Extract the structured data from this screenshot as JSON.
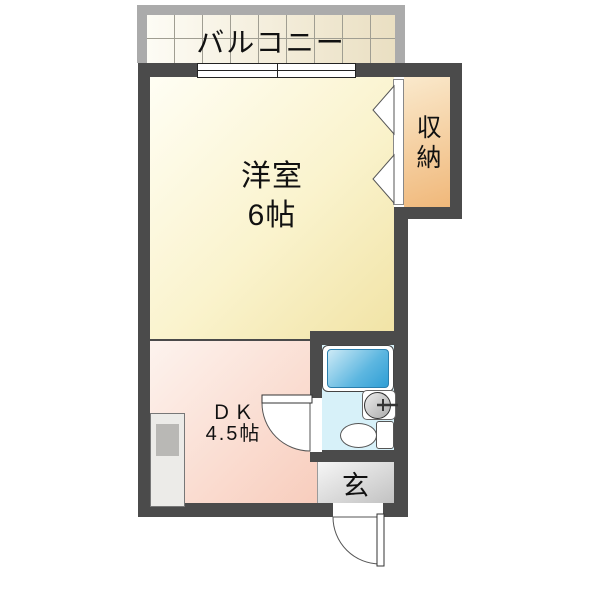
{
  "title": "間取り図 (apartment floor plan)",
  "rooms": {
    "balcony": {
      "label": "バルコニー"
    },
    "living": {
      "label": "洋室",
      "size": "6帖"
    },
    "dining_kitchen": {
      "label": "ＤＫ",
      "size": "4.5帖"
    },
    "closet": {
      "label": "収納"
    },
    "entrance": {
      "label": "玄"
    }
  },
  "fixtures": {
    "bathtub": "bathtub",
    "wash_basin": "wash-basin",
    "toilet": "toilet",
    "kitchen_unit": "kitchen-unit",
    "sliding_window": "sliding-window",
    "folding_closet_door": "bifold-doors",
    "bath_door": "hinged-door",
    "entrance_door": "hinged-door"
  },
  "colors": {
    "wall": "#4b4b4b",
    "living_floor": "#f9f1c6",
    "dk_floor": "#f8cdbd",
    "closet_floor": "#f0b87a",
    "bath_floor": "#d7f1f9",
    "bathtub_water": "#2f9ed5",
    "entrance_floor": "#c2c2c2",
    "balcony_frame": "#ababab"
  }
}
